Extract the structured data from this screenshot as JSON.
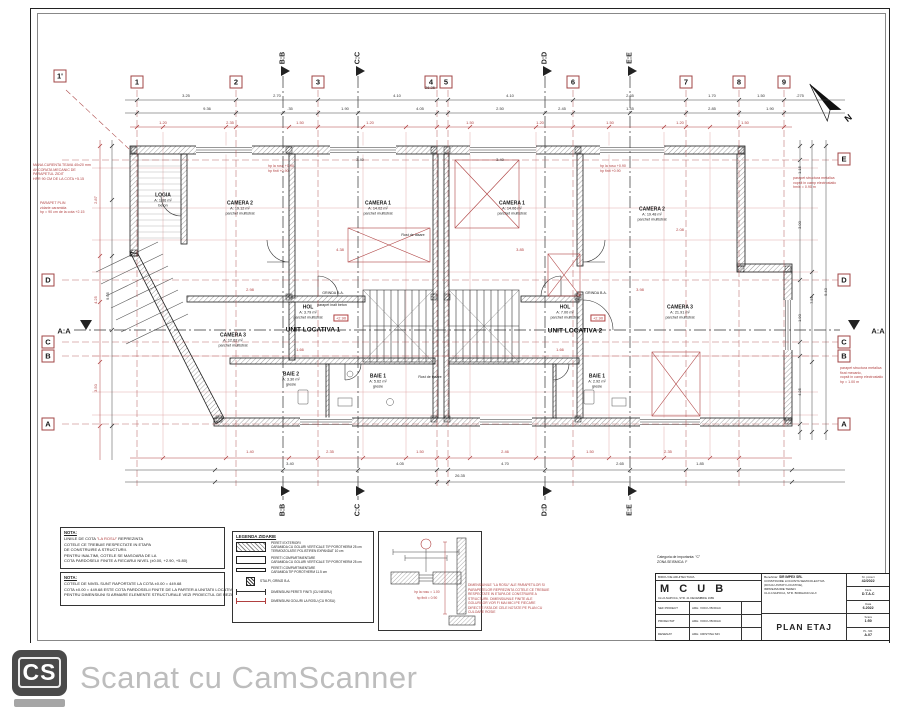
{
  "north": {
    "label": "N"
  },
  "footer": {
    "logo": "CS",
    "text": "Scanat cu CamScanner"
  },
  "grid": {
    "top": [
      {
        "t": "1'",
        "x": 60,
        "y": 76
      },
      {
        "t": "1",
        "x": 137,
        "y": 82
      },
      {
        "t": "2",
        "x": 236,
        "y": 82
      },
      {
        "t": "3",
        "x": 318,
        "y": 82
      },
      {
        "t": "4",
        "x": 431,
        "y": 82
      },
      {
        "t": "5",
        "x": 446,
        "y": 82
      },
      {
        "t": "6",
        "x": 573,
        "y": 82
      },
      {
        "t": "7",
        "x": 686,
        "y": 82
      },
      {
        "t": "8",
        "x": 739,
        "y": 82
      },
      {
        "t": "9",
        "x": 784,
        "y": 82
      }
    ],
    "right": [
      {
        "t": "E",
        "x": 844,
        "y": 159
      },
      {
        "t": "D",
        "x": 844,
        "y": 280
      },
      {
        "t": "C",
        "x": 844,
        "y": 342
      },
      {
        "t": "B",
        "x": 844,
        "y": 356
      },
      {
        "t": "A",
        "x": 844,
        "y": 424
      }
    ],
    "left": [
      {
        "t": "D",
        "x": 48,
        "y": 280
      },
      {
        "t": "C",
        "x": 48,
        "y": 342
      },
      {
        "t": "B",
        "x": 48,
        "y": 356
      },
      {
        "t": "A",
        "x": 48,
        "y": 424
      }
    ],
    "sections_v": [
      {
        "t": "B:B",
        "x": 283
      },
      {
        "t": "C:C",
        "x": 358
      },
      {
        "t": "D:D",
        "x": 545
      },
      {
        "t": "E:E",
        "x": 630
      }
    ],
    "section_h": {
      "t": "A:A"
    },
    "vx": [
      137,
      236,
      318,
      437,
      448,
      573,
      686,
      739,
      784
    ],
    "hy": [
      160,
      280,
      342,
      356,
      424
    ]
  },
  "rooms": [
    {
      "x": 163,
      "y": 200,
      "name": "LOGIA",
      "area": "A: 1.86 m²",
      "finish": "beton"
    },
    {
      "x": 240,
      "y": 208,
      "name": "CAMERA 2",
      "area": "A: 19.12 m²",
      "finish": "parchet multistrat"
    },
    {
      "x": 378,
      "y": 208,
      "name": "CAMERA 1",
      "area": "A: 14.02 m²",
      "finish": "parchet multistrat"
    },
    {
      "x": 512,
      "y": 208,
      "name": "CAMERA 1",
      "area": "A: 14.06 m²",
      "finish": "parchet multistrat"
    },
    {
      "x": 652,
      "y": 214,
      "name": "CAMERA 2",
      "area": "A: 19.48 m²",
      "finish": "parchet multistrat"
    },
    {
      "x": 680,
      "y": 312,
      "name": "CAMERA 3",
      "area": "A: 21.91 m²",
      "finish": "parchet multistrat"
    },
    {
      "x": 233,
      "y": 340,
      "name": "CAMERA 3",
      "area": "A: 12.62 m²",
      "finish": "parchet multistrat"
    },
    {
      "x": 308,
      "y": 312,
      "name": "HOL",
      "area": "A: 3.79 m²",
      "finish": "parchet multistrat"
    },
    {
      "x": 565,
      "y": 312,
      "name": "HOL",
      "area": "A: 7.00 m²",
      "finish": "parchet multistrat"
    },
    {
      "x": 291,
      "y": 379,
      "name": "BAIE 2",
      "area": "A: 3.30 m²",
      "finish": "gresie"
    },
    {
      "x": 378,
      "y": 381,
      "name": "BAIE 1",
      "area": "A: 5.62 m²",
      "finish": "gresie"
    },
    {
      "x": 597,
      "y": 381,
      "name": "BAIE 1",
      "area": "A: 2.92 m²",
      "finish": "gresie"
    }
  ],
  "units": [
    {
      "x": 313,
      "y": 330,
      "t": "UNIT LOCATIVA 1"
    },
    {
      "x": 575,
      "y": 331,
      "t": "UNIT LOCATIVA 2"
    }
  ],
  "badges": [
    {
      "x": 341,
      "y": 318,
      "t": "+2.90"
    },
    {
      "x": 598,
      "y": 318,
      "t": "+2.90"
    }
  ],
  "small_labels": [
    {
      "x": 413,
      "y": 235,
      "t": "Rost de tasare"
    },
    {
      "x": 430,
      "y": 377,
      "t": "Rost de tasare"
    },
    {
      "x": 333,
      "y": 293,
      "t": "GRINDA B.A."
    },
    {
      "x": 596,
      "y": 293,
      "t": "GRINDA B.A."
    },
    {
      "x": 332,
      "y": 305,
      "t": "parapet inalt beton"
    }
  ],
  "red_annotations": [
    {
      "x": 33,
      "y": 163,
      "lines": [
        "MANA CURENTA TEAVA 40x20 mm",
        "ANCORATA MECANIC DE",
        "PARAPETUL ZIDIT",
        "HPR 90 CM DE LA COTA +5.15"
      ]
    },
    {
      "x": 40,
      "y": 201,
      "lines": [
        "PARAPET PLIN",
        "zidarie caramida",
        "hp = 90 cm de la cota +2.15"
      ]
    },
    {
      "x": 793,
      "y": 176,
      "lines": [
        "parapet structura metalica",
        "vopsit in camp electrostatic",
        "hmin = 0.90 m"
      ]
    },
    {
      "x": 840,
      "y": 366,
      "lines": [
        "parapet structura metalica",
        "fixat mecanic,",
        "vopsit in camp electrostatic",
        "hp = 1.00 m"
      ]
    },
    {
      "x": 268,
      "y": 164,
      "lines": [
        "hp la rosu +0.90",
        "hp finit +0.90"
      ]
    },
    {
      "x": 600,
      "y": 164,
      "lines": [
        "hp la rosu +0.90",
        "hp finit +0.90"
      ]
    }
  ],
  "dims": [
    {
      "x": 430,
      "y": 88,
      "t": "26.35"
    },
    {
      "x": 186,
      "y": 96,
      "t": "3.25"
    },
    {
      "x": 277,
      "y": 96,
      "t": "2.70"
    },
    {
      "x": 397,
      "y": 96,
      "t": "4.10"
    },
    {
      "x": 510,
      "y": 96,
      "t": "4.10"
    },
    {
      "x": 630,
      "y": 96,
      "t": "2.65"
    },
    {
      "x": 712,
      "y": 96,
      "t": "1.70"
    },
    {
      "x": 761,
      "y": 96,
      "t": "1.50"
    },
    {
      "x": 800,
      "y": 96,
      "t": ".275"
    },
    {
      "x": 207,
      "y": 109,
      "t": "9.36"
    },
    {
      "x": 290,
      "y": 109,
      "t": ".35"
    },
    {
      "x": 345,
      "y": 109,
      "t": "1.90"
    },
    {
      "x": 420,
      "y": 109,
      "t": "4.05"
    },
    {
      "x": 500,
      "y": 109,
      "t": "2.50"
    },
    {
      "x": 562,
      "y": 109,
      "t": "2.45"
    },
    {
      "x": 630,
      "y": 109,
      "t": "1.45"
    },
    {
      "x": 712,
      "y": 109,
      "t": "2.85"
    },
    {
      "x": 770,
      "y": 109,
      "t": "1.90"
    },
    {
      "x": 163,
      "y": 123,
      "t": "1.20",
      "c": "r"
    },
    {
      "x": 230,
      "y": 123,
      "t": "2.35",
      "c": "r"
    },
    {
      "x": 300,
      "y": 123,
      "t": "1.50",
      "c": "r"
    },
    {
      "x": 370,
      "y": 123,
      "t": "1.20",
      "c": "r"
    },
    {
      "x": 470,
      "y": 123,
      "t": "1.50",
      "c": "r"
    },
    {
      "x": 540,
      "y": 123,
      "t": "1.20",
      "c": "r"
    },
    {
      "x": 610,
      "y": 123,
      "t": "1.50",
      "c": "r"
    },
    {
      "x": 680,
      "y": 123,
      "t": "1.20",
      "c": "r"
    },
    {
      "x": 745,
      "y": 123,
      "t": "1.50",
      "c": "r"
    },
    {
      "x": 250,
      "y": 452,
      "t": "1.40",
      "c": "r"
    },
    {
      "x": 330,
      "y": 452,
      "t": "2.35",
      "c": "r"
    },
    {
      "x": 420,
      "y": 452,
      "t": "1.50",
      "c": "r"
    },
    {
      "x": 505,
      "y": 452,
      "t": "2.46",
      "c": "r"
    },
    {
      "x": 590,
      "y": 452,
      "t": "1.50",
      "c": "r"
    },
    {
      "x": 668,
      "y": 452,
      "t": "2.35",
      "c": "r"
    },
    {
      "x": 290,
      "y": 464,
      "t": "3.40"
    },
    {
      "x": 400,
      "y": 464,
      "t": "4.05"
    },
    {
      "x": 505,
      "y": 464,
      "t": "4.70"
    },
    {
      "x": 620,
      "y": 464,
      "t": "2.65"
    },
    {
      "x": 700,
      "y": 464,
      "t": "1.85"
    },
    {
      "x": 460,
      "y": 476,
      "t": "26.35"
    },
    {
      "x": 800,
      "y": 170,
      "t": "1.15",
      "r": 1
    },
    {
      "x": 800,
      "y": 225,
      "t": "3.00",
      "r": 1
    },
    {
      "x": 800,
      "y": 318,
      "t": "1.90",
      "r": 1
    },
    {
      "x": 800,
      "y": 392,
      "t": "4.25",
      "r": 1
    },
    {
      "x": 812,
      "y": 300,
      "t": "7.55",
      "r": 1
    },
    {
      "x": 826,
      "y": 292,
      "t": "9.43",
      "r": 1
    },
    {
      "x": 96,
      "y": 200,
      "t": "2.87",
      "r": 1,
      "c": "r"
    },
    {
      "x": 96,
      "y": 300,
      "t": "4.25",
      "r": 1,
      "c": "r"
    },
    {
      "x": 96,
      "y": 388,
      "t": "3.50",
      "r": 1,
      "c": "r"
    },
    {
      "x": 108,
      "y": 296,
      "t": "9.05",
      "r": 1
    },
    {
      "x": 340,
      "y": 250,
      "t": "4.38",
      "c": "r"
    },
    {
      "x": 250,
      "y": 290,
      "t": "2.98",
      "c": "r"
    },
    {
      "x": 520,
      "y": 250,
      "t": "3.85",
      "c": "r"
    },
    {
      "x": 640,
      "y": 290,
      "t": "3.98",
      "c": "r"
    },
    {
      "x": 300,
      "y": 350,
      "t": "1.66",
      "c": "r"
    },
    {
      "x": 560,
      "y": 350,
      "t": "1.66",
      "c": "r"
    },
    {
      "x": 680,
      "y": 230,
      "t": "2.08",
      "c": "r"
    },
    {
      "x": 360,
      "y": 160,
      "t": "3.40"
    },
    {
      "x": 500,
      "y": 160,
      "t": "3.40"
    }
  ],
  "chains": {
    "h": [
      {
        "y": 100,
        "x1": 125,
        "x2": 845,
        "xs": [
          137,
          236,
          318,
          437,
          448,
          573,
          686,
          739,
          784
        ],
        "c": "k"
      },
      {
        "y": 113,
        "x1": 125,
        "x2": 845,
        "xs": [
          137,
          236,
          283,
          318,
          358,
          437,
          448,
          545,
          573,
          630,
          686,
          739,
          784
        ],
        "c": "k"
      },
      {
        "y": 127,
        "x1": 130,
        "x2": 792,
        "xs": [
          137,
          163,
          226,
          236,
          289,
          318,
          363,
          406,
          437,
          448,
          470,
          536,
          573,
          609,
          664,
          686,
          710,
          739,
          784
        ],
        "c": "r"
      },
      {
        "y": 458,
        "x1": 130,
        "x2": 792,
        "xs": [
          163,
          226,
          289,
          318,
          363,
          406,
          437,
          448,
          470,
          536,
          573,
          609,
          664,
          710,
          739
        ],
        "c": "r"
      },
      {
        "y": 470,
        "x1": 125,
        "x2": 845,
        "xs": [
          215,
          283,
          358,
          437,
          448,
          545,
          630,
          686,
          739,
          792
        ],
        "c": "k"
      },
      {
        "y": 482,
        "x1": 125,
        "x2": 845,
        "xs": [
          215,
          437,
          448,
          792
        ],
        "c": "k"
      }
    ],
    "v": [
      {
        "x": 800,
        "y1": 140,
        "y2": 440,
        "ys": [
          146,
          160,
          280,
          342,
          356,
          424,
          432
        ],
        "c": "k"
      },
      {
        "x": 812,
        "y1": 140,
        "y2": 440,
        "ys": [
          146,
          272,
          296,
          362,
          432
        ],
        "c": "k"
      },
      {
        "x": 826,
        "y1": 140,
        "y2": 440,
        "ys": [
          146,
          432
        ],
        "c": "k"
      },
      {
        "x": 100,
        "y1": 140,
        "y2": 460,
        "ys": [
          146,
          256,
          302,
          362,
          426
        ],
        "c": "r"
      },
      {
        "x": 112,
        "y1": 140,
        "y2": 460,
        "ys": [
          146,
          200,
          256,
          330,
          426
        ],
        "c": "k"
      }
    ]
  },
  "notes": {
    "box1": {
      "title": "NOTA:",
      "lines": [
        [
          {
            "t": "LINIILE DE COTA "
          },
          {
            "t": "\"LA ROSU\"",
            "r": true
          },
          {
            "t": " REPREZINTA"
          }
        ],
        "COTELE CE TREBUIE RESPECTATE IN ETAPA",
        "DE CONSTRUIRE A STRUCTURII.",
        "PENTRU INALTIMI, COTELE SE MASOARA DE LA",
        "COTA PARDOSELII FINITE A FIECARUI NIVEL (±0.00, +2.90, +5.80)"
      ]
    },
    "box2": {
      "title": "NOTA:",
      "lines": [
        "COTELE DE NIVEL SUNT RAPORTATE LA COTA ±0.00 = 449.68",
        "COTA ±0.00 = 449.68 ESTE COTA PARDOSELII FINITE DE LA PARTER A UNITATII LOCATIVE NR.1",
        "PENTRU DIMENSIUNI SI ARMARE ELEMENTE STRUCTURALE VEZI PROIECTUL DE REZISTENTA"
      ]
    }
  },
  "legend": {
    "title": "LEGENDA ZIDARIE",
    "items": [
      {
        "sw": "ext",
        "lines": [
          "PERETI EXTERIORI",
          "CARAMIDA CU GOLURI VERTICALE TIP POROTHERM 25 cm",
          "TERMOIZOLATIE POLISTIREN EXPANDAT 10 cm"
        ]
      },
      {
        "sw": "p25",
        "lines": [
          "PERETI COMPARTIMENTARE",
          "CARAMIDA CU GOLURI VERTICALE TIP POROTHERM 25 cm"
        ]
      },
      {
        "sw": "p11",
        "lines": [
          "PERETI COMPARTIMENTARE",
          "CARAMIDA TIP POROTHERM 11.5 cm"
        ]
      },
      {
        "sw": "col",
        "lines": [
          "STALPI, GRINZI B.A."
        ]
      },
      {
        "sw": "dimk",
        "lines": [
          "DIMENSIUNI PERETI FINITI (CU NEGRU)"
        ]
      },
      {
        "sw": "dimr",
        "lines": [
          "DIMENSIUNI GOLURI LA ROSU (CU ROSU)"
        ]
      }
    ]
  },
  "detail": {
    "l1": "hp la rosu = 1.00",
    "l2": "hp finit = 0.90"
  },
  "red_note": {
    "lines": [
      "DIMENSIUNILE \"LA ROSU\" ALE PARAPETILOR SI",
      "PARAPETELOR REPREZINTA COTELE CE TREBUIE",
      "RESPECTATE IN ETAPA DE CONSTRUIRE A",
      "STRUCTURII. DIMENSIUNILE FINITE ALE",
      "GOLURILOR VOR FI MAI MICI PE FIECARE",
      "DIRECTIE FATA DE CELE NOTATE PE PLAN CU",
      "CULOARE ROSIE"
    ]
  },
  "titleblock": {
    "categoria": "Categoria de importanta: \"C\"",
    "zona": "ZONA SEISMICA: F",
    "birou": "BIROU DE ARHITECTURA",
    "brand": "M C U B",
    "address": "CLUJ-NAPOCA, STR. 21 DECEMBRIE 1989",
    "personnel": [
      {
        "role": "SEF PROIECT",
        "name": "ARH. VOICU BODAC"
      },
      {
        "role": "PROIECTAT",
        "name": "ARH. VOICU BODAC"
      },
      {
        "role": "DESENAT",
        "name": "ARH. CRISTINA SIN"
      }
    ],
    "beneficiar_label": "Beneficiar:",
    "beneficiar": "SIR IMPEX SRL",
    "proiect_lines": [
      "CONSTRUIRE LOCUINTA SEMICOLECTIVA",
      "(DOUA UNITATI LOCATIVE),",
      "IMPREJMUIRE TEREN",
      "CLUJ-NAPOCA, STR. BORHANCULUI"
    ],
    "plansa": "PLAN ETAJ",
    "meta": [
      {
        "label": "Nr. proiect",
        "value": "42/2022"
      },
      {
        "label": "Faza",
        "value": "D.T.A.C"
      },
      {
        "label": "Data",
        "value": "6.2022"
      },
      {
        "label": "Scara",
        "value": "1:50"
      },
      {
        "label": "PL. NR.",
        "value": "A.07"
      }
    ]
  }
}
